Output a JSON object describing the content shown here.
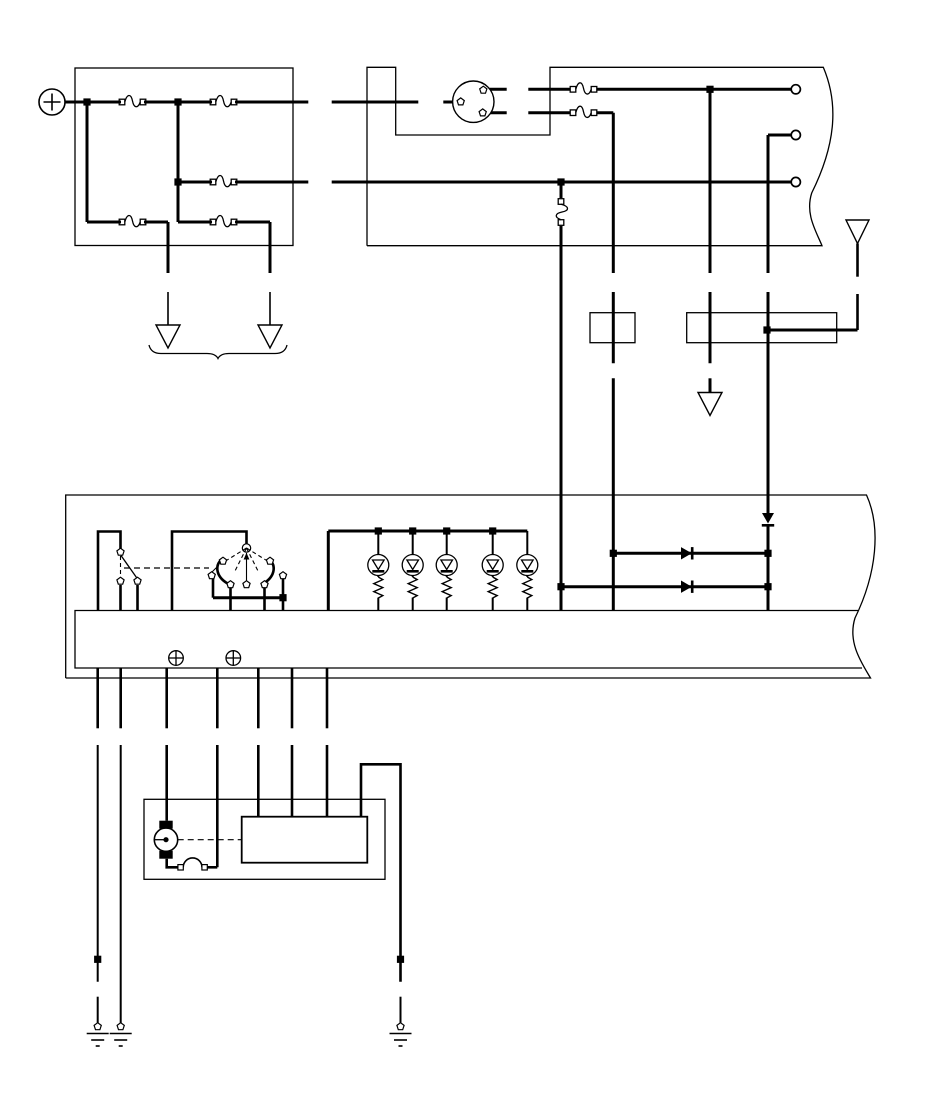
{
  "meta": {
    "title": "Automotive wiring schematic (no text labels)",
    "background_color": "#ffffff",
    "ink_color": "#000000",
    "canvas": {
      "width": 950,
      "height": 1108
    }
  },
  "components": {
    "battery_positive_terminal": {
      "symbol": "circled-plus",
      "count": 1
    },
    "main_fuse_block": {
      "fuse_count": 5
    },
    "ignition_switch": {
      "symbol": "circle-with-3-terminals",
      "terminal_count": 3
    },
    "branch_fuses": {
      "count": 2
    },
    "inline_vertical_fuse": {
      "count": 1
    },
    "harness_output_terminals": {
      "count": 3
    },
    "torn_edge_boxes": {
      "count": 2
    },
    "inline_component_boxes": {
      "small": 1,
      "wide": 1
    },
    "antenna": {
      "count": 1
    },
    "off_page_arrows": {
      "count": 3
    },
    "group_brace": {
      "count": 1
    },
    "controller_box": {
      "toggle_switch_terminals": 3,
      "rotary_switch_positions": 7,
      "led_indicators": 5,
      "resistors": 5,
      "horizontal_diodes": 2,
      "vertical_diode": 1,
      "mounting_screws": 2
    },
    "motor_assembly": {
      "motor": 1,
      "bridge_connector": 1,
      "driver_module": 1
    },
    "chassis_grounds": {
      "count": 3
    },
    "splice_dots": {
      "count": 2
    },
    "connector_breaks": {
      "count": 14
    }
  }
}
